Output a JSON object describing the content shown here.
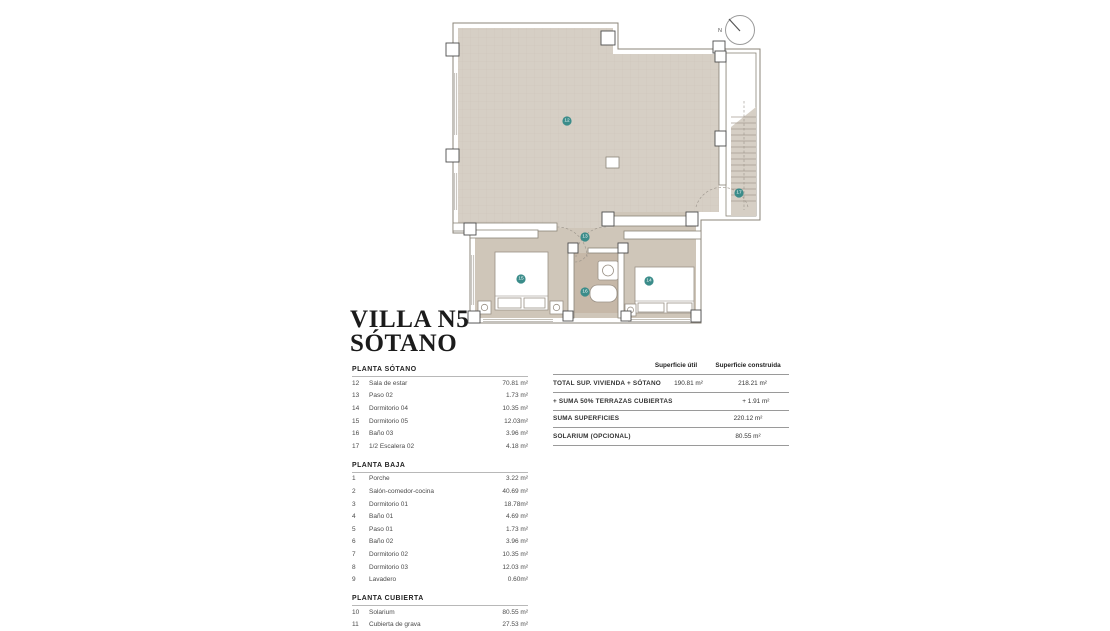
{
  "title": {
    "line1": "VILLA N5",
    "line2": "SÓTANO"
  },
  "legend": {
    "sections": [
      {
        "header": "PLANTA SÓTANO",
        "items": [
          {
            "num": "12",
            "name": "Sala de estar",
            "value": "70.81 m²"
          },
          {
            "num": "13",
            "name": "Paso 02",
            "value": "1.73 m²"
          },
          {
            "num": "14",
            "name": "Dormitorio 04",
            "value": "10.35 m²"
          },
          {
            "num": "15",
            "name": "Dormitorio 05",
            "value": "12.03m²"
          },
          {
            "num": "16",
            "name": "Baño 03",
            "value": "3.96 m²"
          },
          {
            "num": "17",
            "name": "1/2 Escalera 02",
            "value": "4.18 m²"
          }
        ]
      },
      {
        "header": "PLANTA BAJA",
        "items": [
          {
            "num": "1",
            "name": "Porche",
            "value": "3.22 m²"
          },
          {
            "num": "2",
            "name": "Salón-comedor-cocina",
            "value": "40.69 m²"
          },
          {
            "num": "3",
            "name": "Dormitorio 01",
            "value": "18.78m²"
          },
          {
            "num": "4",
            "name": "Baño 01",
            "value": "4.69 m²"
          },
          {
            "num": "5",
            "name": "Paso 01",
            "value": "1.73 m²"
          },
          {
            "num": "6",
            "name": "Baño 02",
            "value": "3.96 m²"
          },
          {
            "num": "7",
            "name": "Dormitorio 02",
            "value": "10.35 m²"
          },
          {
            "num": "8",
            "name": "Dormitorio 03",
            "value": "12.03 m²"
          },
          {
            "num": "9",
            "name": "Lavadero",
            "value": "0.60m²"
          }
        ]
      },
      {
        "header": "PLANTA CUBIERTA",
        "items": [
          {
            "num": "10",
            "name": "Solarium",
            "value": "80.55 m²"
          },
          {
            "num": "11",
            "name": "Cubierta de grava",
            "value": "27.53 m²"
          }
        ]
      }
    ]
  },
  "summary": {
    "col_util": "Superficie útil",
    "col_construida": "Superficie construida",
    "rows": [
      {
        "label": "TOTAL SUP. VIVIENDA + SÓTANO",
        "util": "190.81 m²",
        "construida": "218.21 m²"
      },
      {
        "label": "+ SUMA 50% TERRAZAS CUBIERTAS",
        "util": "",
        "construida": "+ 1.91 m²"
      },
      {
        "label": "SUMA SUPERFICIES",
        "util": "",
        "construida": "220.12 m²"
      },
      {
        "label": "SOLARIUM (OPCIONAL)",
        "util": "",
        "construida": "80.55 m²"
      }
    ]
  },
  "plan": {
    "compass_label": "N",
    "badges": [
      {
        "n": "12",
        "x": 129,
        "y": 116
      },
      {
        "n": "13",
        "x": 147,
        "y": 232
      },
      {
        "n": "14",
        "x": 211,
        "y": 276
      },
      {
        "n": "15",
        "x": 83,
        "y": 274
      },
      {
        "n": "16",
        "x": 147,
        "y": 287
      },
      {
        "n": "17",
        "x": 301,
        "y": 188
      }
    ],
    "colors": {
      "floor_main": "#d6cfc5",
      "floor_wing": "#cfc6b9",
      "floor_bath": "#c6b8a8",
      "wall_stroke": "#8b8478",
      "badge": "#3a8c8a"
    }
  }
}
